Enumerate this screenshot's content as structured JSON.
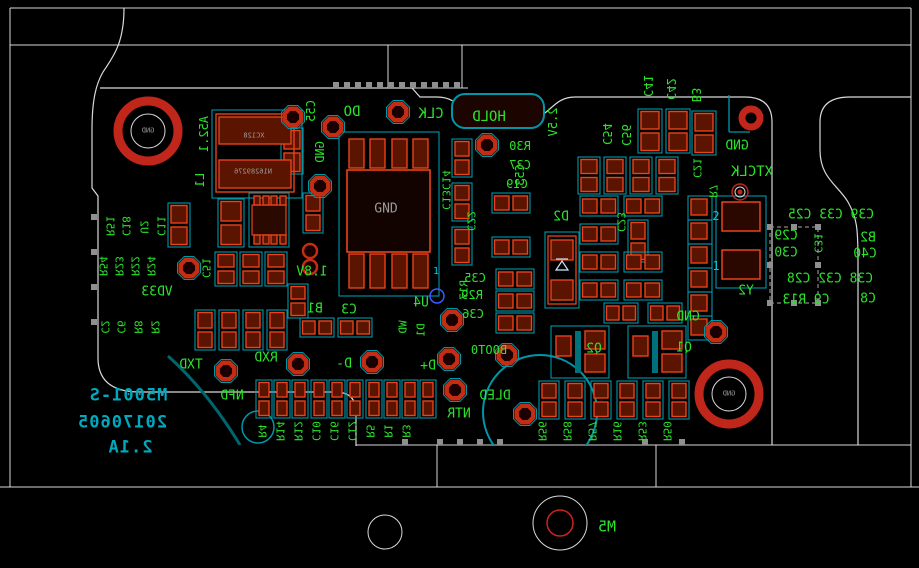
{
  "app": {
    "view": "pcb-layout-bottom-mirrored"
  },
  "colors": {
    "background": "#000000",
    "silkscreen_green": "#2be32b",
    "board_outline_white": "#d9d9d9",
    "courtyard_cyan": "#0096a8",
    "pad_red": "#e8431a",
    "pad_fill": "#5a1400",
    "hole_ring_red": "#c1261b",
    "teal_text": "#00a9bd",
    "gray_text": "#9a9a9a",
    "cyan_text": "#00c8dc",
    "via_blue": "#3a5bff",
    "handle_gray": "#8f8f8f"
  },
  "board_text": {
    "part_number": "M5001-S",
    "date_code": "20170605",
    "version": "2.1A"
  },
  "labels": [
    {
      "t": "DO",
      "x": 352,
      "y": 112,
      "d": "h",
      "s": 14
    },
    {
      "t": "CLK",
      "x": 431,
      "y": 114,
      "d": "h",
      "s": 14
    },
    {
      "t": "HOLD",
      "x": 489,
      "y": 117,
      "d": "h",
      "s": 14
    },
    {
      "t": "GND",
      "x": 737,
      "y": 146,
      "d": "h",
      "s": 13
    },
    {
      "t": "XTCLK",
      "x": 752,
      "y": 172,
      "d": "h",
      "s": 14
    },
    {
      "t": "R30",
      "x": 520,
      "y": 146,
      "d": "h",
      "s": 12
    },
    {
      "t": "C37",
      "x": 520,
      "y": 165,
      "d": "h",
      "s": 12
    },
    {
      "t": "C19",
      "x": 517,
      "y": 184,
      "d": "h",
      "s": 12
    },
    {
      "t": "D2",
      "x": 561,
      "y": 217,
      "d": "h",
      "s": 13
    },
    {
      "t": "C35",
      "x": 475,
      "y": 278,
      "d": "h",
      "s": 12
    },
    {
      "t": "R29",
      "x": 472,
      "y": 295,
      "d": "h",
      "s": 12
    },
    {
      "t": "C36",
      "x": 473,
      "y": 314,
      "d": "h",
      "s": 12
    },
    {
      "t": "BOOT0",
      "x": 489,
      "y": 350,
      "d": "h",
      "s": 12
    },
    {
      "t": "U4",
      "x": 421,
      "y": 303,
      "d": "h",
      "s": 13
    },
    {
      "t": "C3",
      "x": 349,
      "y": 310,
      "d": "h",
      "s": 13
    },
    {
      "t": "B1",
      "x": 315,
      "y": 309,
      "d": "h",
      "s": 13
    },
    {
      "t": "1.8V",
      "x": 312,
      "y": 272,
      "d": "h",
      "s": 13
    },
    {
      "t": "TXD",
      "x": 191,
      "y": 365,
      "d": "h",
      "s": 13
    },
    {
      "t": "RXD",
      "x": 266,
      "y": 358,
      "d": "h",
      "s": 13
    },
    {
      "t": "NFD",
      "x": 232,
      "y": 396,
      "d": "h",
      "s": 13
    },
    {
      "t": "D-",
      "x": 344,
      "y": 364,
      "d": "h",
      "s": 13
    },
    {
      "t": "D+",
      "x": 428,
      "y": 366,
      "d": "h",
      "s": 13
    },
    {
      "t": "DLED",
      "x": 495,
      "y": 396,
      "d": "h",
      "s": 13
    },
    {
      "t": "NTR",
      "x": 459,
      "y": 414,
      "d": "h",
      "s": 13
    },
    {
      "t": "Y2",
      "x": 746,
      "y": 291,
      "d": "h",
      "s": 13
    },
    {
      "t": "M5",
      "x": 607,
      "y": 527,
      "d": "h",
      "s": 15
    },
    {
      "t": "VD33",
      "x": 157,
      "y": 292,
      "d": "h",
      "s": 13
    },
    {
      "t": "GND",
      "x": 688,
      "y": 317,
      "d": "h",
      "s": 13
    },
    {
      "t": "Q2",
      "x": 594,
      "y": 349,
      "d": "h",
      "s": 13
    },
    {
      "t": "Q1",
      "x": 684,
      "y": 348,
      "d": "h",
      "s": 13
    },
    {
      "t": "C39 C33 C25",
      "x": 831,
      "y": 215,
      "d": "h",
      "s": 13
    },
    {
      "t": "C29",
      "x": 786,
      "y": 236,
      "d": "h",
      "s": 13
    },
    {
      "t": "B2",
      "x": 868,
      "y": 238,
      "d": "h",
      "s": 13
    },
    {
      "t": "C30",
      "x": 786,
      "y": 253,
      "d": "h",
      "s": 13
    },
    {
      "t": "C40",
      "x": 865,
      "y": 254,
      "d": "h",
      "s": 13
    },
    {
      "t": "C38 C32 C28",
      "x": 830,
      "y": 279,
      "d": "h",
      "s": 13
    },
    {
      "t": "C9 R13",
      "x": 806,
      "y": 300,
      "d": "h",
      "s": 13
    },
    {
      "t": "C8",
      "x": 868,
      "y": 299,
      "d": "h",
      "s": 13
    },
    {
      "t": "GND",
      "x": 386,
      "y": 209,
      "d": "n",
      "s": 13,
      "c": "y"
    },
    {
      "t": "2",
      "x": 716,
      "y": 216,
      "d": "n",
      "s": 12,
      "c": "c"
    },
    {
      "t": "1",
      "x": 716,
      "y": 266,
      "d": "n",
      "s": 12,
      "c": "c"
    },
    {
      "t": "1",
      "x": 436,
      "y": 272,
      "d": "n",
      "s": 10,
      "c": "c"
    },
    {
      "t": "M5001-S",
      "x": 128,
      "y": 396,
      "d": "h",
      "s": 17,
      "c": "t"
    },
    {
      "t": "20170605",
      "x": 122,
      "y": 423,
      "d": "h",
      "s": 17,
      "c": "t"
    },
    {
      "t": "2.1A",
      "x": 130,
      "y": 448,
      "d": "h",
      "s": 17,
      "c": "t"
    },
    {
      "t": "GND",
      "x": 148,
      "y": 131,
      "d": "h",
      "s": 7,
      "c": "y"
    },
    {
      "t": "GND",
      "x": 729,
      "y": 394,
      "d": "h",
      "s": 7,
      "c": "y"
    },
    {
      "t": "XC128",
      "x": 254,
      "y": 136,
      "d": "h",
      "s": 7,
      "c": "y"
    },
    {
      "t": "N16289276",
      "x": 253,
      "y": 172,
      "d": "h",
      "s": 7,
      "c": "y"
    },
    {
      "t": "C41",
      "x": 648,
      "y": 86,
      "d": "u",
      "s": 12
    },
    {
      "t": "C42",
      "x": 671,
      "y": 89,
      "d": "u",
      "s": 12
    },
    {
      "t": "B3",
      "x": 696,
      "y": 95,
      "d": "u",
      "s": 12
    },
    {
      "t": "C54",
      "x": 607,
      "y": 134,
      "d": "u",
      "s": 12
    },
    {
      "t": "C56",
      "x": 626,
      "y": 135,
      "d": "u",
      "s": 12
    },
    {
      "t": "C13C14",
      "x": 446,
      "y": 190,
      "d": "u",
      "s": 11
    },
    {
      "t": "C22",
      "x": 471,
      "y": 221,
      "d": "u",
      "s": 11
    },
    {
      "t": "C23",
      "x": 621,
      "y": 222,
      "d": "u",
      "s": 11
    },
    {
      "t": "R51",
      "x": 110,
      "y": 226,
      "d": "u",
      "s": 11
    },
    {
      "t": "C18",
      "x": 126,
      "y": 226,
      "d": "u",
      "s": 11
    },
    {
      "t": "U2",
      "x": 144,
      "y": 227,
      "d": "u",
      "s": 11
    },
    {
      "t": "C11",
      "x": 161,
      "y": 226,
      "d": "u",
      "s": 11
    },
    {
      "t": "R54",
      "x": 103,
      "y": 266,
      "d": "u",
      "s": 11
    },
    {
      "t": "R23",
      "x": 119,
      "y": 266,
      "d": "u",
      "s": 11
    },
    {
      "t": "R22",
      "x": 135,
      "y": 266,
      "d": "u",
      "s": 11
    },
    {
      "t": "R24",
      "x": 151,
      "y": 266,
      "d": "u",
      "s": 11
    },
    {
      "t": "C51",
      "x": 206,
      "y": 268,
      "d": "u",
      "s": 11
    },
    {
      "t": "C2",
      "x": 105,
      "y": 327,
      "d": "u",
      "s": 11
    },
    {
      "t": "C6",
      "x": 121,
      "y": 327,
      "d": "u",
      "s": 11
    },
    {
      "t": "R8",
      "x": 138,
      "y": 327,
      "d": "u",
      "s": 11
    },
    {
      "t": "R2",
      "x": 155,
      "y": 327,
      "d": "u",
      "s": 11
    },
    {
      "t": "R4",
      "x": 262,
      "y": 431,
      "d": "u",
      "s": 11
    },
    {
      "t": "R14",
      "x": 280,
      "y": 431,
      "d": "u",
      "s": 11
    },
    {
      "t": "R12",
      "x": 298,
      "y": 431,
      "d": "u",
      "s": 11
    },
    {
      "t": "C10",
      "x": 316,
      "y": 431,
      "d": "u",
      "s": 11
    },
    {
      "t": "C16",
      "x": 334,
      "y": 431,
      "d": "u",
      "s": 11
    },
    {
      "t": "C12",
      "x": 352,
      "y": 431,
      "d": "u",
      "s": 11
    },
    {
      "t": "R5",
      "x": 370,
      "y": 431,
      "d": "u",
      "s": 11
    },
    {
      "t": "R1",
      "x": 388,
      "y": 431,
      "d": "u",
      "s": 11
    },
    {
      "t": "R3",
      "x": 406,
      "y": 431,
      "d": "u",
      "s": 11
    },
    {
      "t": "R56",
      "x": 542,
      "y": 431,
      "d": "u",
      "s": 11
    },
    {
      "t": "R58",
      "x": 567,
      "y": 431,
      "d": "u",
      "s": 11
    },
    {
      "t": "R57",
      "x": 592,
      "y": 431,
      "d": "u",
      "s": 11
    },
    {
      "t": "R16",
      "x": 617,
      "y": 431,
      "d": "u",
      "s": 11
    },
    {
      "t": "R53",
      "x": 642,
      "y": 431,
      "d": "u",
      "s": 11
    },
    {
      "t": "R50",
      "x": 667,
      "y": 431,
      "d": "u",
      "s": 11
    },
    {
      "t": "C21",
      "x": 697,
      "y": 168,
      "d": "u",
      "s": 11
    },
    {
      "t": "R7",
      "x": 713,
      "y": 191,
      "d": "u",
      "s": 11
    },
    {
      "t": "C31",
      "x": 818,
      "y": 243,
      "d": "u",
      "s": 11
    },
    {
      "t": "A52.1",
      "x": 204,
      "y": 134,
      "d": "d",
      "s": 12
    },
    {
      "t": "L1",
      "x": 200,
      "y": 180,
      "d": "d",
      "s": 12
    },
    {
      "t": "C55",
      "x": 311,
      "y": 111,
      "d": "d",
      "s": 12
    },
    {
      "t": "GND",
      "x": 320,
      "y": 152,
      "d": "d",
      "s": 12
    },
    {
      "t": "2.5V",
      "x": 553,
      "y": 122,
      "d": "d",
      "s": 12
    },
    {
      "t": "C53",
      "x": 520,
      "y": 175,
      "d": "d",
      "s": 12
    },
    {
      "t": "R17",
      "x": 464,
      "y": 290,
      "d": "d",
      "s": 11
    },
    {
      "t": "WD",
      "x": 403,
      "y": 327,
      "d": "d",
      "s": 11
    },
    {
      "t": "D1",
      "x": 421,
      "y": 330,
      "d": "d",
      "s": 11
    }
  ],
  "graphics": {
    "lines": [
      [
        10,
        8,
        911,
        8
      ],
      [
        10,
        45,
        911,
        45
      ],
      [
        10,
        8,
        10,
        487
      ],
      [
        911,
        8,
        911,
        487
      ],
      [
        0,
        487,
        919,
        487
      ],
      [
        356,
        445,
        911,
        445
      ],
      [
        437,
        445,
        437,
        487
      ],
      [
        656,
        445,
        656,
        487
      ],
      [
        388,
        45,
        388,
        88
      ],
      [
        462,
        45,
        462,
        88
      ],
      [
        260,
        88,
        468,
        88
      ]
    ],
    "cyan_lines": [
      [
        729,
        95,
        729,
        132
      ],
      [
        729,
        132,
        750,
        132
      ]
    ],
    "board_paths": [
      "M 124 8 C 124 45 112 58 103 72 C 96 84 92 100 92 130 L 92 188 L 98 196 L 98 358 Q 98 392 140 392 L 335 392 Q 356 392 356 412 L 356 446",
      "M 100 88 L 412 88 L 420 97 L 437 97 C 466 97 462 126 506 126 C 550 126 548 97 575 97 L 745 97 Q 772 97 772 122 L 772 445",
      "M 911 97 L 850 97 Q 820 97 820 122 L 820 150 C 820 178 838 185 848 202 C 857 218 858 228 858 262 L 858 445"
    ],
    "qfn": {
      "court": [
        339,
        132,
        100,
        164
      ],
      "body": [
        347,
        170,
        83,
        82
      ],
      "pad_xs": [
        349,
        370,
        392,
        413
      ],
      "pad_w": 15,
      "top_y": 139,
      "top_h": 29,
      "bot_y": 254,
      "bot_h": 34
    },
    "l1": {
      "court": [
        212,
        110,
        90,
        88
      ],
      "rect": [
        216,
        114,
        78,
        78
      ],
      "pads": [
        [
          219,
          117,
          72,
          27
        ],
        [
          219,
          160,
          72,
          28
        ]
      ]
    },
    "soic": {
      "body": [
        252,
        205,
        34,
        30
      ],
      "pad_xs": [
        254,
        263,
        271,
        280
      ],
      "pad_w": 6,
      "top_y": 196,
      "bot_y": 235,
      "pad_h": 9
    },
    "d2": {
      "court": [
        545,
        232,
        34,
        76
      ],
      "rect": [
        548,
        236,
        28,
        68
      ],
      "pads": [
        [
          551,
          240,
          22,
          20
        ],
        [
          551,
          280,
          22,
          20
        ]
      ]
    },
    "crystal": {
      "court": [
        716,
        196,
        50,
        92
      ],
      "pads": [
        [
          722,
          202,
          38,
          29
        ],
        [
          722,
          250,
          38,
          29
        ]
      ]
    },
    "sot23": [
      {
        "court": [
          551,
          326,
          58,
          52
        ],
        "left": [
          556,
          336,
          15,
          20
        ],
        "bar": [
          575,
          331,
          6,
          42
        ],
        "r1": [
          585,
          331,
          20,
          18
        ],
        "r2": [
          585,
          354,
          20,
          18
        ]
      },
      {
        "court": [
          628,
          326,
          58,
          52
        ],
        "left": [
          633,
          336,
          15,
          20
        ],
        "bar": [
          652,
          331,
          6,
          42
        ],
        "r1": [
          662,
          331,
          20,
          18
        ],
        "r2": [
          662,
          354,
          20,
          18
        ]
      }
    ],
    "hold_pad": [
      452,
      94,
      92,
      34
    ],
    "padpairs_v": [
      [
        281,
        128,
        22,
        46
      ],
      [
        168,
        203,
        22,
        44
      ],
      [
        218,
        199,
        26,
        48
      ],
      [
        303,
        193,
        20,
        40
      ],
      [
        215,
        252,
        22,
        34
      ],
      [
        240,
        252,
        22,
        34
      ],
      [
        265,
        252,
        22,
        34
      ],
      [
        195,
        310,
        20,
        40
      ],
      [
        219,
        310,
        20,
        40
      ],
      [
        243,
        310,
        20,
        40
      ],
      [
        267,
        310,
        20,
        40
      ],
      [
        288,
        284,
        20,
        34
      ],
      [
        452,
        139,
        20,
        38
      ],
      [
        452,
        183,
        20,
        38
      ],
      [
        452,
        227,
        20,
        38
      ],
      [
        578,
        157,
        22,
        37
      ],
      [
        604,
        157,
        22,
        37
      ],
      [
        630,
        157,
        22,
        37
      ],
      [
        656,
        157,
        22,
        37
      ],
      [
        638,
        109,
        24,
        44
      ],
      [
        666,
        109,
        24,
        44
      ],
      [
        692,
        111,
        24,
        44
      ],
      [
        628,
        220,
        20,
        42
      ],
      [
        256,
        380,
        16,
        38
      ],
      [
        274,
        380,
        16,
        38
      ],
      [
        292,
        380,
        16,
        38
      ],
      [
        311,
        380,
        16,
        38
      ],
      [
        329,
        380,
        16,
        38
      ],
      [
        347,
        380,
        16,
        38
      ],
      [
        366,
        380,
        16,
        38
      ],
      [
        384,
        380,
        16,
        38
      ],
      [
        402,
        380,
        16,
        38
      ],
      [
        420,
        380,
        16,
        38
      ],
      [
        539,
        381,
        20,
        38
      ],
      [
        565,
        381,
        20,
        38
      ],
      [
        591,
        381,
        20,
        38
      ],
      [
        617,
        381,
        20,
        38
      ],
      [
        643,
        381,
        20,
        38
      ],
      [
        669,
        381,
        20,
        38
      ]
    ],
    "padpairs_h": [
      [
        492,
        193,
        38,
        20
      ],
      [
        492,
        237,
        38,
        20
      ],
      [
        496,
        269,
        38,
        20
      ],
      [
        496,
        291,
        38,
        20
      ],
      [
        496,
        313,
        38,
        20
      ],
      [
        580,
        196,
        38,
        20
      ],
      [
        624,
        196,
        38,
        20
      ],
      [
        580,
        224,
        38,
        20
      ],
      [
        580,
        252,
        38,
        20
      ],
      [
        624,
        252,
        38,
        20
      ],
      [
        580,
        280,
        38,
        20
      ],
      [
        624,
        280,
        38,
        20
      ],
      [
        604,
        303,
        34,
        20
      ],
      [
        648,
        303,
        34,
        20
      ],
      [
        300,
        318,
        34,
        19
      ],
      [
        338,
        318,
        34,
        19
      ]
    ],
    "edge_pads": {
      "x": 690,
      "ys": [
        198,
        222,
        246,
        270,
        294,
        318
      ],
      "size": 20
    },
    "rail_pads": {
      "y": 85,
      "xs": [
        336,
        347,
        358,
        369,
        380,
        391,
        402,
        413,
        424,
        435,
        446,
        457
      ],
      "size": 6
    },
    "handles": {
      "left": {
        "x": 94,
        "ys": [
          217,
          252,
          287,
          322
        ]
      },
      "bottom": {
        "y": 442,
        "xs": [
          405,
          440,
          460,
          480,
          500,
          645,
          682
        ]
      }
    },
    "selection_box": [
      770,
      227,
      48,
      76
    ],
    "testpoints": [
      [
        293,
        117
      ],
      [
        333,
        127
      ],
      [
        398,
        112
      ],
      [
        320,
        186
      ],
      [
        487,
        145
      ],
      [
        189,
        268
      ],
      [
        226,
        371
      ],
      [
        298,
        364
      ],
      [
        372,
        362
      ],
      [
        449,
        359
      ],
      [
        452,
        320
      ],
      [
        507,
        355
      ],
      [
        455,
        390
      ],
      [
        525,
        414
      ],
      [
        716,
        332
      ]
    ],
    "small_vias": [
      [
        310,
        251
      ],
      [
        310,
        267
      ]
    ],
    "via_target": [
      740,
      192
    ],
    "blue_via": [
      437,
      296
    ],
    "holes": {
      "big": [
        [
          148,
          131
        ],
        [
          729,
          394
        ]
      ],
      "medium": [
        751,
        118
      ],
      "m5": [
        560,
        523
      ],
      "plain": [
        385,
        532
      ]
    },
    "dled_circle": [
      540,
      412,
      57
    ],
    "nfd_circle": [
      258,
      427,
      16
    ],
    "arc_path": "M 168 356 Q 208 392 240 445"
  }
}
